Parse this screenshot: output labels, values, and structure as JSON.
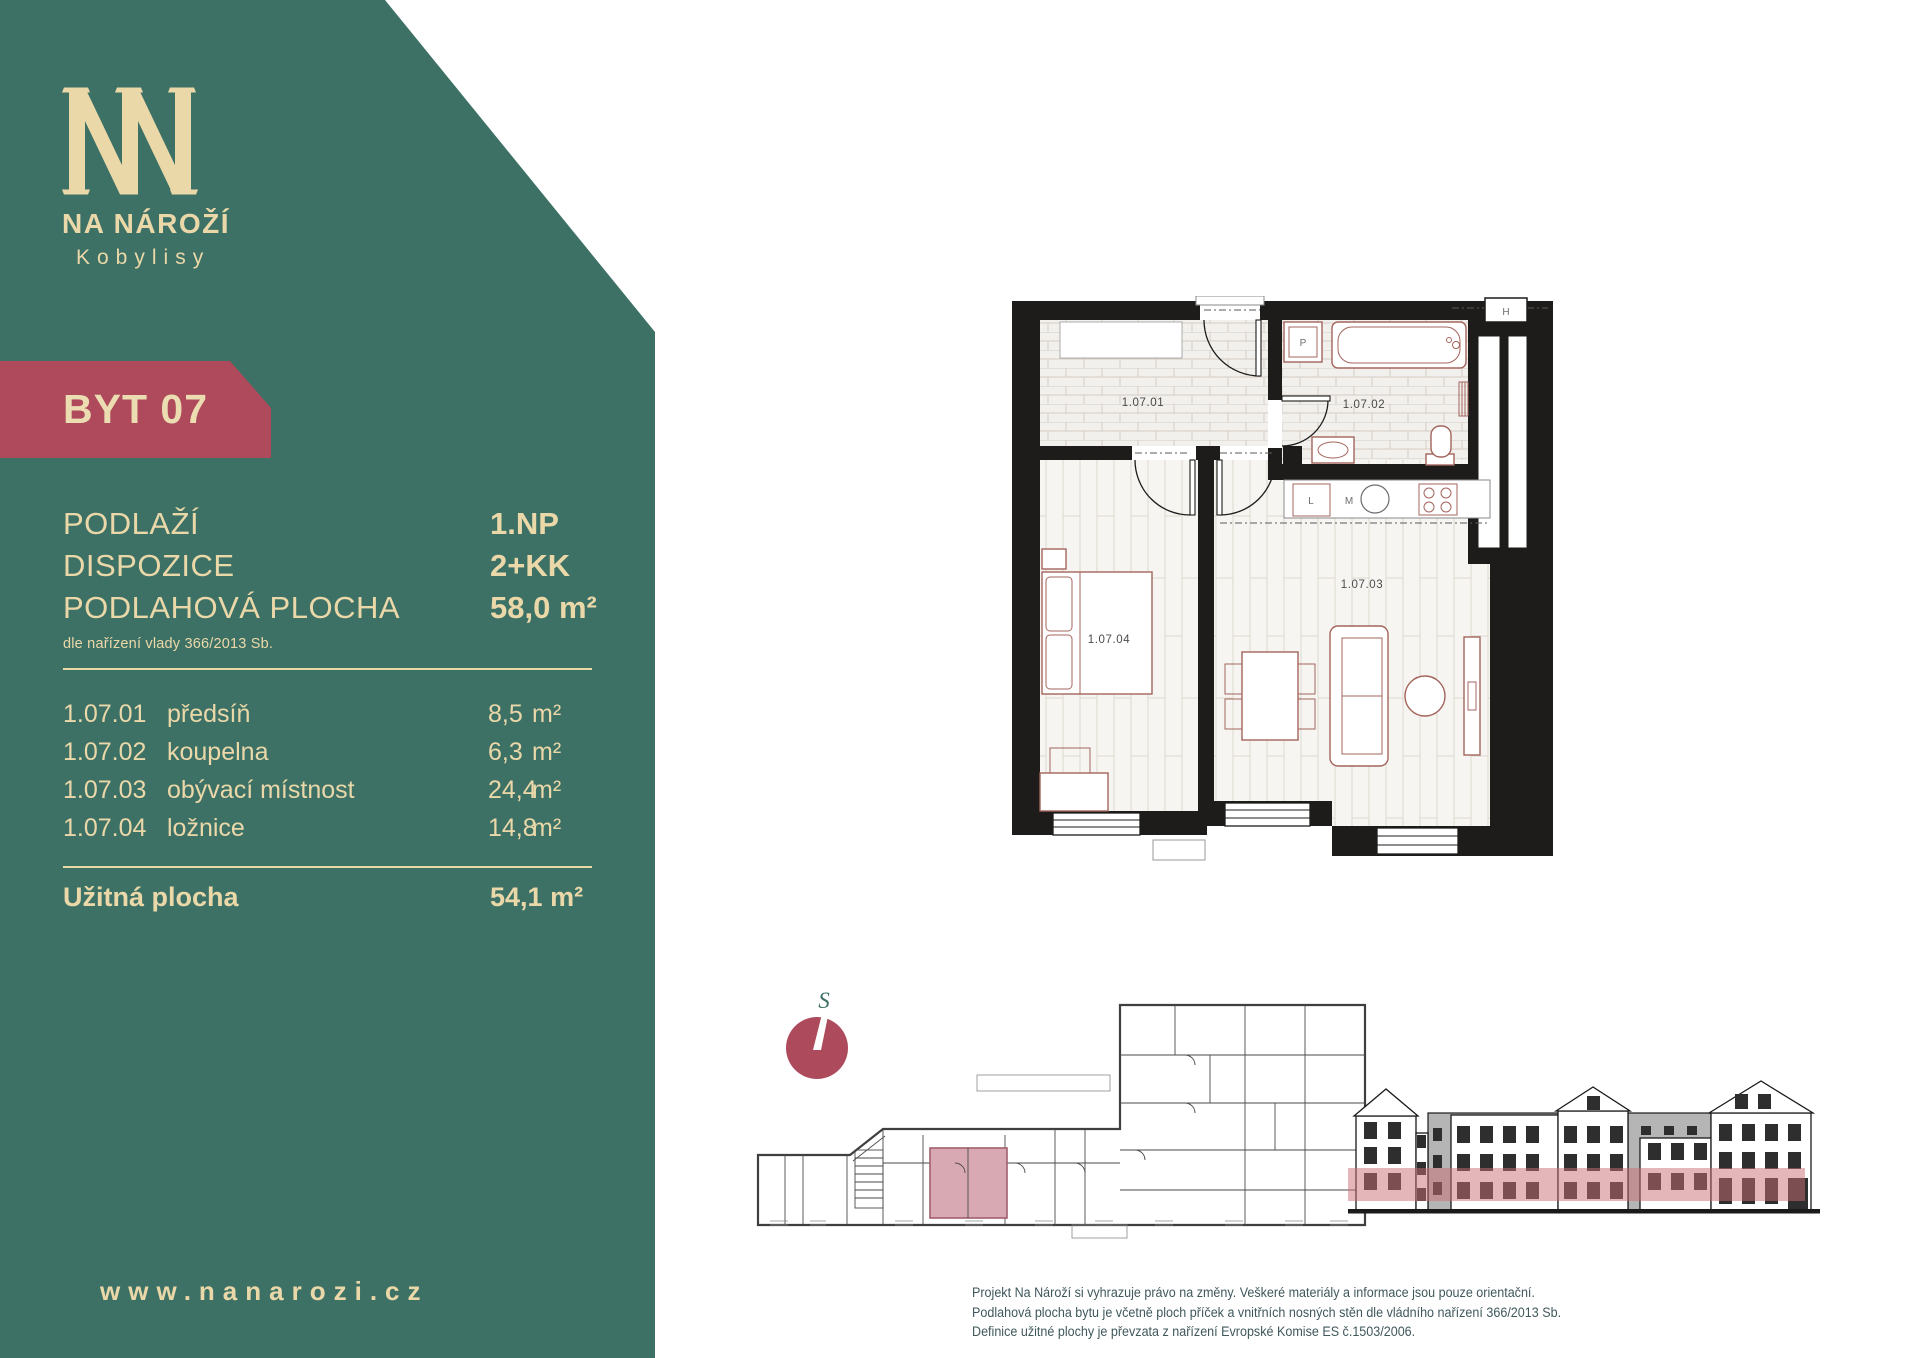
{
  "colors": {
    "teal": "#3e7166",
    "cream": "#ebd8a9",
    "maroon": "#ae4a5b",
    "pink_unit": "#d9a9b3",
    "elevation_band": "#c96d76",
    "wall": "#1d1c1a"
  },
  "brand": {
    "name": "NA NÁROŽÍ",
    "city": "Kobylisy",
    "website": "www.nanarozi.cz"
  },
  "unit": {
    "badge": "BYT 07"
  },
  "attributes": {
    "rows": [
      {
        "label": "PODLAŽÍ",
        "value": "1.NP"
      },
      {
        "label": "DISPOZICE",
        "value": "2+KK"
      },
      {
        "label": "PODLAHOVÁ PLOCHA",
        "value": "58,0",
        "unit": "m²"
      }
    ],
    "note": "dle nařízení vlady 366/2013 Sb."
  },
  "rooms": {
    "items": [
      {
        "code": "1.07.01",
        "name": "předsíň",
        "area": "8,5",
        "unit": "m²"
      },
      {
        "code": "1.07.02",
        "name": "koupelna",
        "area": "6,3",
        "unit": "m²"
      },
      {
        "code": "1.07.03",
        "name": "obývací místnost",
        "area": "24,4",
        "unit": "m²"
      },
      {
        "code": "1.07.04",
        "name": "ložnice",
        "area": "14,8",
        "unit": "m²"
      }
    ],
    "total_label": "Užitná plocha",
    "total_area": "54,1",
    "total_unit": "m²"
  },
  "floor_plan": {
    "labels": {
      "room1": "1.07.01",
      "room2": "1.07.02",
      "room3": "1.07.03",
      "room4": "1.07.04",
      "washer": "P",
      "shaft": "H",
      "kitchen_l": "L",
      "kitchen_m": "M"
    }
  },
  "compass": {
    "north_label": "S"
  },
  "disclaimer": {
    "lines": [
      "Projekt Na Nároží si vyhrazuje právo na změny. Veškeré materiály a informace jsou pouze orientační.",
      "Podlahová plocha bytu je včetně ploch příček a vnitřních nosných stěn dle vládního nařízení 366/2013 Sb.",
      "Definice užitné plochy je převzata z nařízení Evropské Komise ES č.1503/2006."
    ]
  }
}
